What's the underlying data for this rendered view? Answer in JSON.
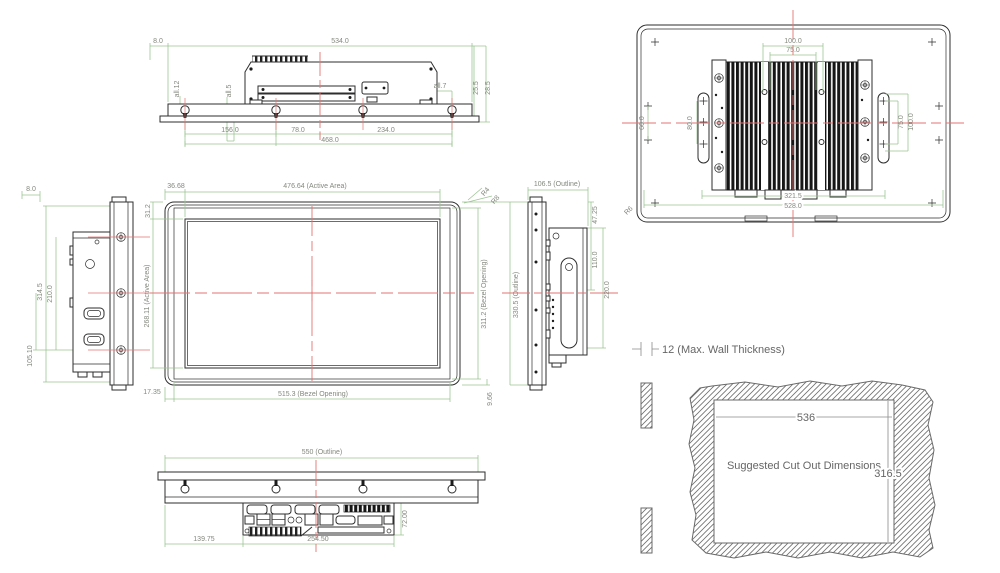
{
  "drawing": {
    "type": "multi-view mechanical dimension drawing of a panel PC",
    "units": "mm",
    "colors": {
      "dimension_line": "#9cc593",
      "dimension_text": "#84887e",
      "centerline": "#e57373",
      "outline": "#2e2e2e",
      "cutout_text": "#666666"
    }
  },
  "views": {
    "top": {
      "dims": {
        "offset": "8.0",
        "overall": "534.0",
        "note_left": "all.12",
        "note_mid": "all.5",
        "note_right": "all.7",
        "bezel_thickness": "25.5",
        "total_thickness": "28.5",
        "pitch1": "156.0",
        "pitch2": "78.0",
        "pitch3": "234.0",
        "pitch_total": "468.0"
      }
    },
    "rear": {
      "dims": {
        "vesa_top_outer": "100.0",
        "vesa_top_inner": "75.0",
        "left_offset": "60.0",
        "slot_left": "80.0",
        "slot_right_inner": "75.0",
        "slot_right_outer": "100.0",
        "heatsink_width": "321.5",
        "body_width": "528.0",
        "corner_radius": "R6"
      }
    },
    "left": {
      "dims": {
        "offset": "8.0",
        "height_total": "314.5",
        "pitch": "210.0",
        "pitch_half": "105.10"
      }
    },
    "front": {
      "dims": {
        "active_offset_x": "36.68",
        "active_width": "476.64 (Active Area)",
        "active_offset_y": "31.2",
        "active_height": "268.11 (Active Area)",
        "bezel_offset_x": "17.35",
        "bezel_width": "515.3 (Bezel Opening)",
        "bezel_height": "311.2 (Bezel Opening)",
        "bezel_offset_y": "9.66",
        "radius_outer": "R4",
        "radius_inner": "R8"
      }
    },
    "right": {
      "dims": {
        "depth": "106.5 (Outline)",
        "height": "330.5 (Outline)",
        "offset_top": "47.25",
        "pitch_half": "110.0",
        "pitch": "220.0"
      }
    },
    "bottom": {
      "dims": {
        "width": "550 (Outline)",
        "io_offset": "139.75",
        "io_width": "254.50",
        "io_depth": "72.00"
      }
    },
    "cutout": {
      "labels": {
        "wall_thickness": "12 (Max. Wall Thickness)",
        "width": "536",
        "note": "Suggested Cut Out Dimensions",
        "height": "316.5"
      }
    }
  }
}
